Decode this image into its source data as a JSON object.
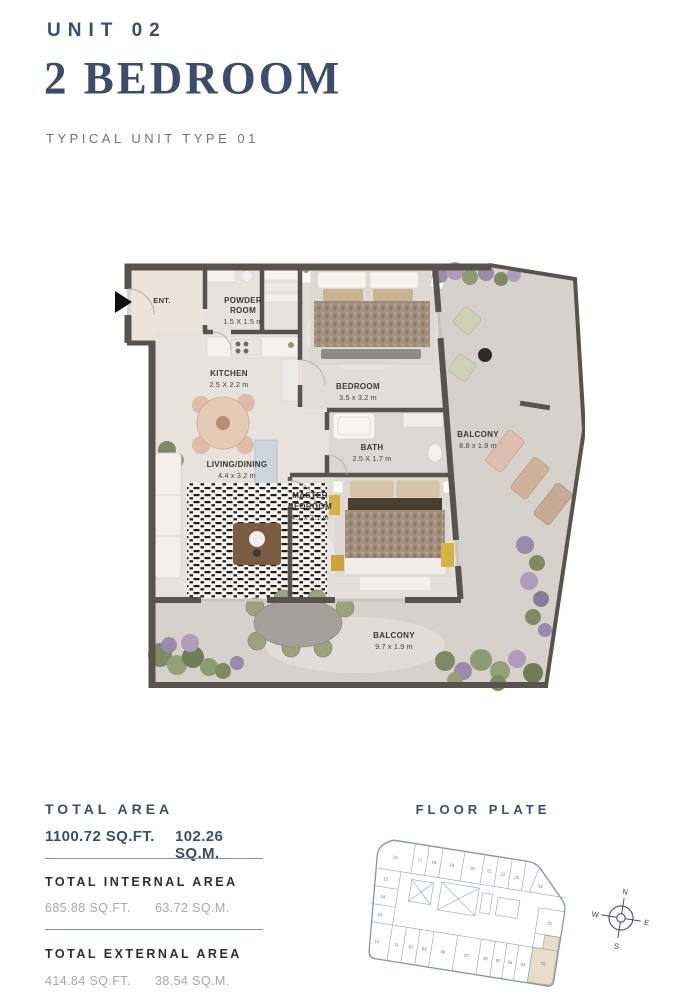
{
  "header": {
    "unit_label": "UNIT 02",
    "title": "2 BEDROOM",
    "subtitle": "TYPICAL UNIT TYPE 01"
  },
  "plan": {
    "entry": "ENT.",
    "powder": {
      "l1": "POWDER",
      "l2": "ROOM",
      "dims": "1.5 X 1.5 m"
    },
    "kitchen": {
      "name": "KITCHEN",
      "dims": "2.5 X 2.2 m"
    },
    "bedroom": {
      "name": "BEDROOM",
      "dims": "3.5 x 3.2 m"
    },
    "bath": {
      "name": "BATH",
      "dims": "2.5 X 1.7 m"
    },
    "living": {
      "name": "LIVING/DINING",
      "dims": "4.4 x 3.2 m"
    },
    "master": {
      "l1": "MASTER",
      "l2": "BEDROOM",
      "dims": "4.1 x 3.1 m"
    },
    "balcony_side": {
      "name": "BALCONY",
      "dims": "8.8 x 1.9 m"
    },
    "balcony_bottom": {
      "name": "BALCONY",
      "dims": "9.7 x 1.9 m"
    }
  },
  "stats": {
    "total": {
      "label": "TOTAL AREA",
      "sqft": "1100.72 SQ.FT.",
      "sqm": "102.26 SQ.M."
    },
    "internal": {
      "label": "TOTAL INTERNAL AREA",
      "sqft": "685.88 SQ.FT.",
      "sqm": "63.72 SQ.M."
    },
    "external": {
      "label": "TOTAL EXTERNAL AREA",
      "sqft": "414.84 SQ.FT.",
      "sqm": "38.54 SQ.M."
    }
  },
  "floor_plate": {
    "title": "FLOOR PLATE",
    "highlighted_unit": "02",
    "units": [
      "01",
      "02",
      "03",
      "04",
      "05",
      "06",
      "07",
      "08",
      "09",
      "10",
      "11",
      "12",
      "13",
      "14",
      "15",
      "16",
      "17",
      "18",
      "19",
      "20",
      "21",
      "22",
      "23",
      "24"
    ],
    "compass": {
      "n": "N",
      "e": "E",
      "s": "S",
      "w": "W"
    }
  },
  "colors": {
    "accent_navy": "#3e4c6c",
    "wall": "#57534e",
    "floor": "#e7e2db",
    "balcony_floor": "#d6d2cb",
    "highlight_beige": "#e8ddc8"
  }
}
